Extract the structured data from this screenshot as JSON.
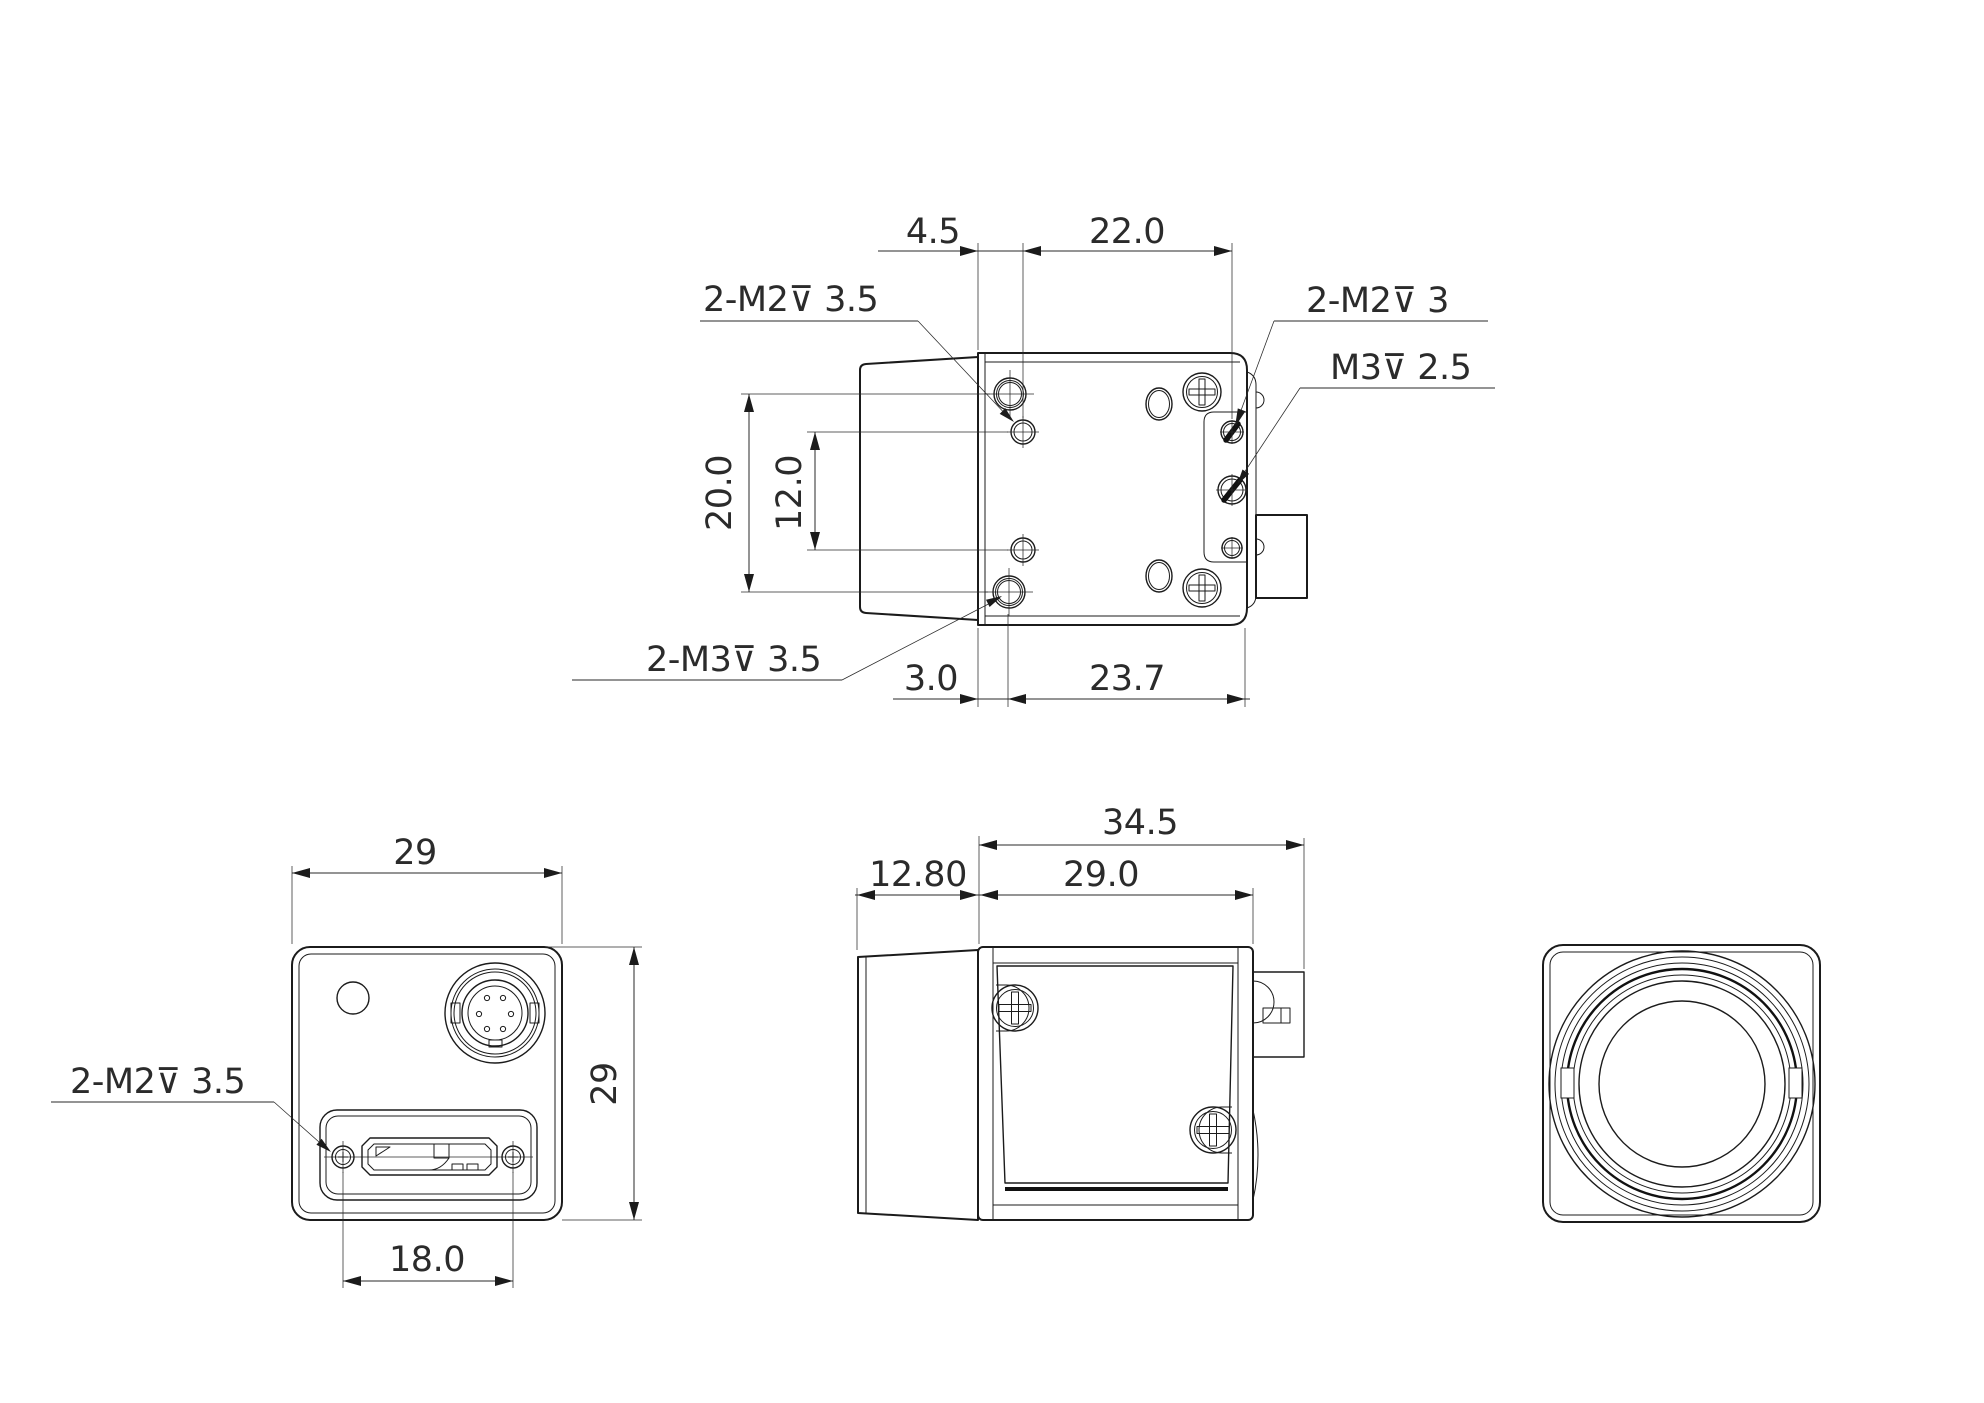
{
  "drawing": {
    "type": "engineering-drawing",
    "line_color": "#1b1b1b",
    "background": "#ffffff",
    "views": {
      "top_view": {
        "labels": {
          "front_m2": "2-M2⊽ 3.5",
          "rear_m2": "2-M2⊽ 3",
          "rear_m3": "M3⊽ 2.5",
          "front_m3": "2-M3⊽ 3.5"
        },
        "dimensions": {
          "front_offset": "4.5",
          "hole_span": "22.0",
          "vert_outer_span": "20.0",
          "vert_inner_span": "12.0",
          "rear_offset": "3.0",
          "rear_span": "23.7"
        }
      },
      "back_view": {
        "labels": {
          "usb_screws_m2": "2-M2⊽ 3.5"
        },
        "dimensions": {
          "width": "29",
          "height": "29",
          "usb_screw_span": "18.0"
        }
      },
      "side_view": {
        "dimensions": {
          "total_depth": "34.5",
          "lens_depth": "12.80",
          "body_depth": "29.0"
        }
      },
      "front_view": {}
    }
  }
}
